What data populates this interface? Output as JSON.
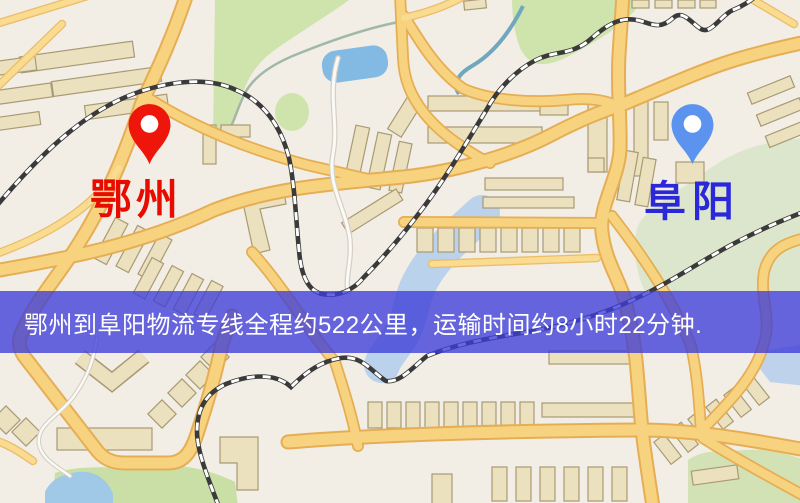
{
  "markers": {
    "origin": {
      "label": "鄂州",
      "pin_color": "#ee150a",
      "label_color": "#e80c00"
    },
    "destination": {
      "label": "阜阳",
      "pin_color": "#5b93ef",
      "label_color": "#2a28d8"
    }
  },
  "banner": {
    "text": "鄂州到阜阳物流专线全程约522公里，运输时间约8小时22分钟.",
    "background_color": "rgba(62,62,216,0.78)",
    "text_color": "#ffffff"
  },
  "route": {
    "origin_city": "鄂州",
    "destination_city": "阜阳",
    "distance_km": "522",
    "duration": "8小时22分钟"
  },
  "map_palette": {
    "background": "#f2eee6",
    "road_fill": "#f9d37c",
    "road_casing": "#e7ae52",
    "building_fill": "#ece1bd",
    "building_stroke": "#a89a72",
    "park_green": "#cfe3ab",
    "park_pale": "#dbe6cb",
    "water_blue": "#82bae6",
    "river_blue": "#b9d2ec",
    "railway_dark": "#3a3a3a"
  }
}
